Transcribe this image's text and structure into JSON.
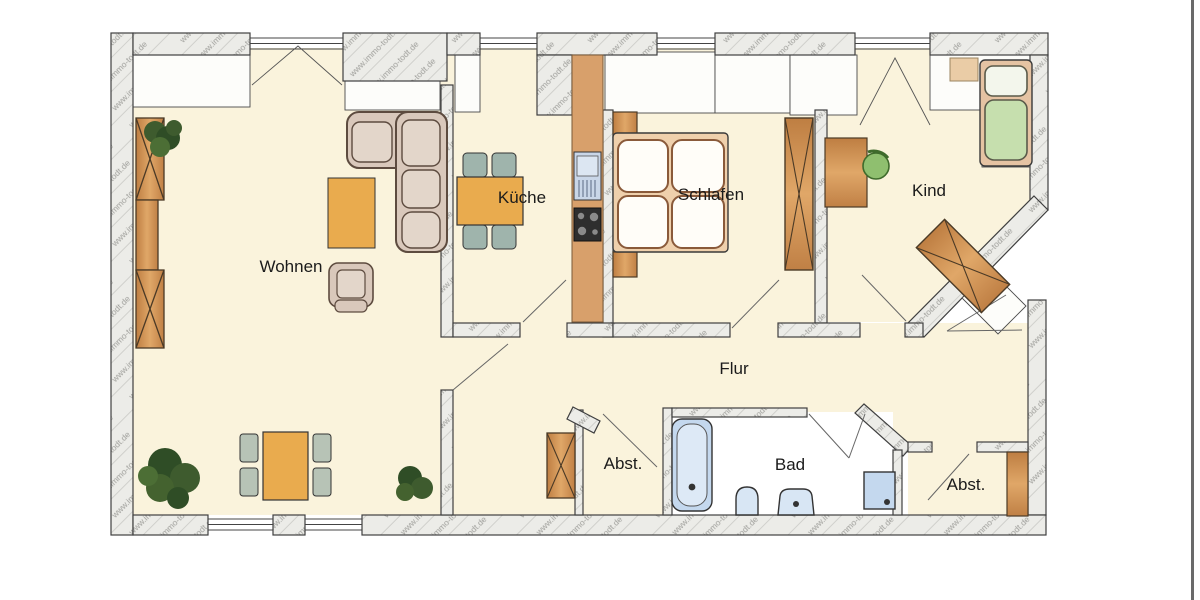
{
  "watermark": {
    "text": "www.immo-todt.de",
    "color": "#a0a09c"
  },
  "rooms": {
    "living": {
      "label": "Wohnen"
    },
    "kitchen": {
      "label": "Küche"
    },
    "bedroom": {
      "label": "Schlafen"
    },
    "child": {
      "label": "Kind"
    },
    "hallway": {
      "label": "Flur"
    },
    "bath": {
      "label": "Bad"
    },
    "storage_mid": {
      "label": "Abst."
    },
    "storage_right": {
      "label": "Abst."
    }
  },
  "colors": {
    "floor_cream": "#FAF3DC",
    "wall_hatch_base": "#ECECE8",
    "wall_outline": "#3f3f3f",
    "wood_brown": "#CE9055",
    "counter_brown": "#D8A06B",
    "table_orange": "#E9AB4E",
    "chair_green_gray": "#B7C3B6",
    "sofa_beige": "#D9C8BB",
    "bath_blue": "#D8E6F4",
    "plant_green": "#3E5B2E",
    "kid_bed_green": "#C6DFAE",
    "page_edge": "#6a6a6a"
  }
}
